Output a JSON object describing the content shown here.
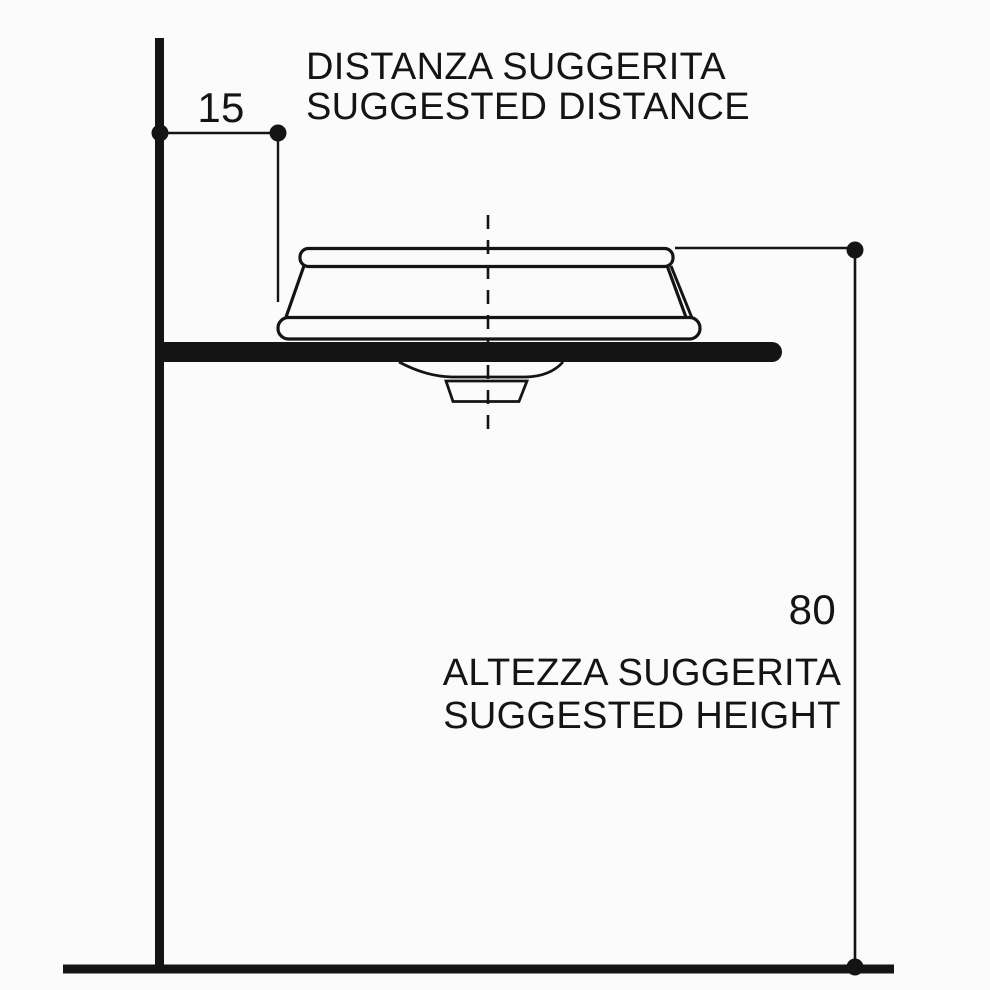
{
  "colors": {
    "background": "#fbfbfb",
    "line": "#141414"
  },
  "annotations": {
    "distance": {
      "label_it": "DISTANZA SUGGERITA",
      "label_en": "SUGGESTED DISTANCE",
      "value": "15"
    },
    "height": {
      "label_it": "ALTEZZA SUGGERITA",
      "label_en": "SUGGESTED HEIGHT",
      "value": "80"
    }
  }
}
